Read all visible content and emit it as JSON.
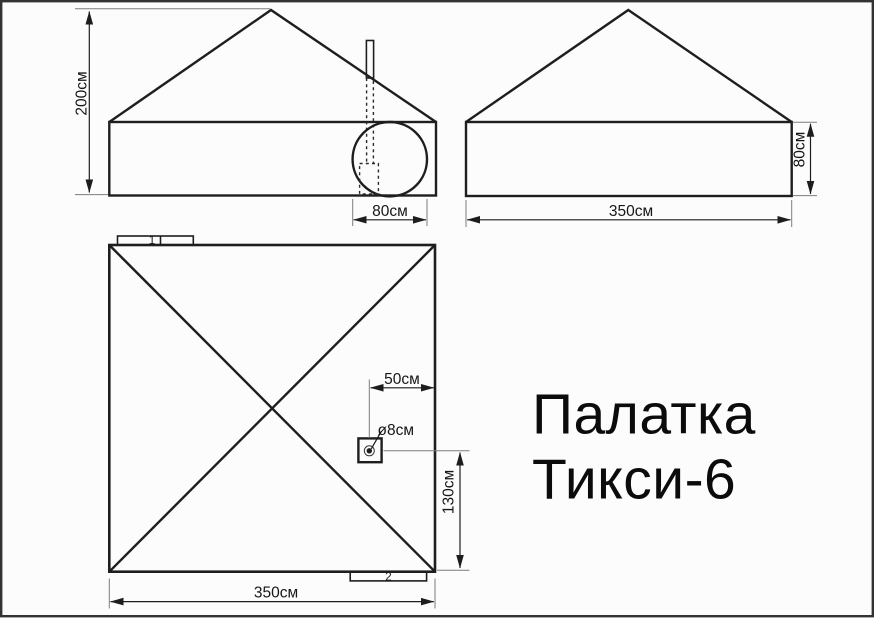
{
  "title": {
    "line1": "Палатка",
    "line2": "Тикси-6"
  },
  "views": {
    "front": {
      "height_label": "200см",
      "window_width_label": "80см"
    },
    "side": {
      "wall_height_label": "80см",
      "width_label": "350см"
    },
    "plan": {
      "marker_top": "1",
      "marker_bottom": "2",
      "pipe_offset_x_label": "50см",
      "pipe_diameter_label": "ø8см",
      "pipe_offset_y_label": "130см",
      "width_label": "350см"
    }
  }
}
